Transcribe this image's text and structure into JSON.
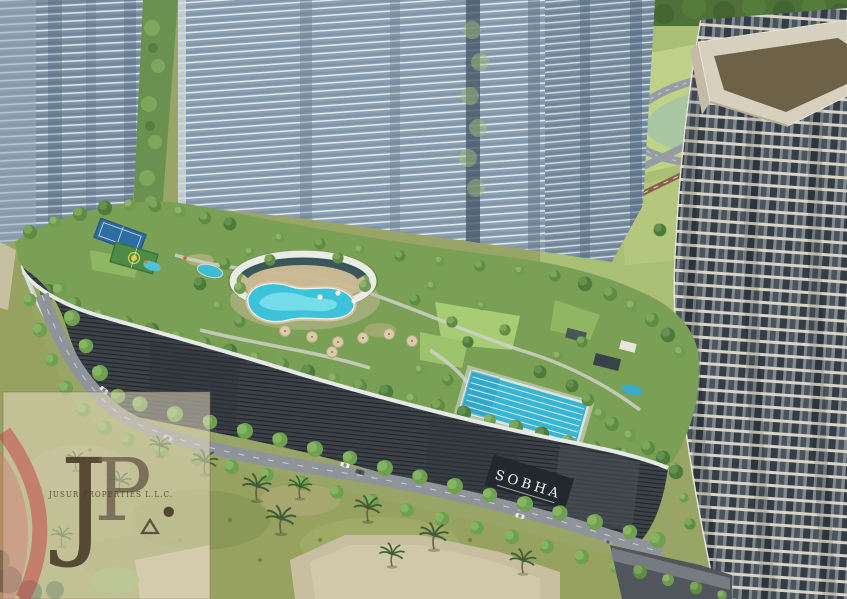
{
  "image": {
    "kind": "aerial-architectural-rendering",
    "description": "Aerial rendering of a Sobha residential development: glass towers, rooftop amenity podium with lagoon pool, lap pool and sports courts, tree-lined street, scrubland foreground, developer watermark"
  },
  "signage": {
    "podium_sign": "SOBHA"
  },
  "watermark": {
    "monogram_j": "J",
    "monogram_p": "P",
    "monogram_period": ".",
    "company": "JUSUR PROPERTIES L.L.C."
  },
  "palette": {
    "glass_tower": "#7e93a5",
    "center_tower": "#8ba0b1",
    "right_tower_frame": "#d7d0bf",
    "right_tower_window": "#343d45",
    "podium_facade": "#3b4248",
    "podium_rim": "#e6e9e6",
    "deck_green": "#79a054",
    "lagoon_pool": "#3cc3da",
    "lap_pool": "#39b4d4",
    "tennis_court": "#2e6ca1",
    "basketball_court": "#4e8b47",
    "sand_deck": "#cbb995",
    "scrubland": "#97a261",
    "plaza": "#c8bea0",
    "road": "#8e9499",
    "sign_background": "#23282d",
    "sign_text": "#f2f3f1",
    "watermark_card": "#e9dfc5",
    "watermark_red": "#c63c44",
    "watermark_text": "#4d3d2b"
  }
}
